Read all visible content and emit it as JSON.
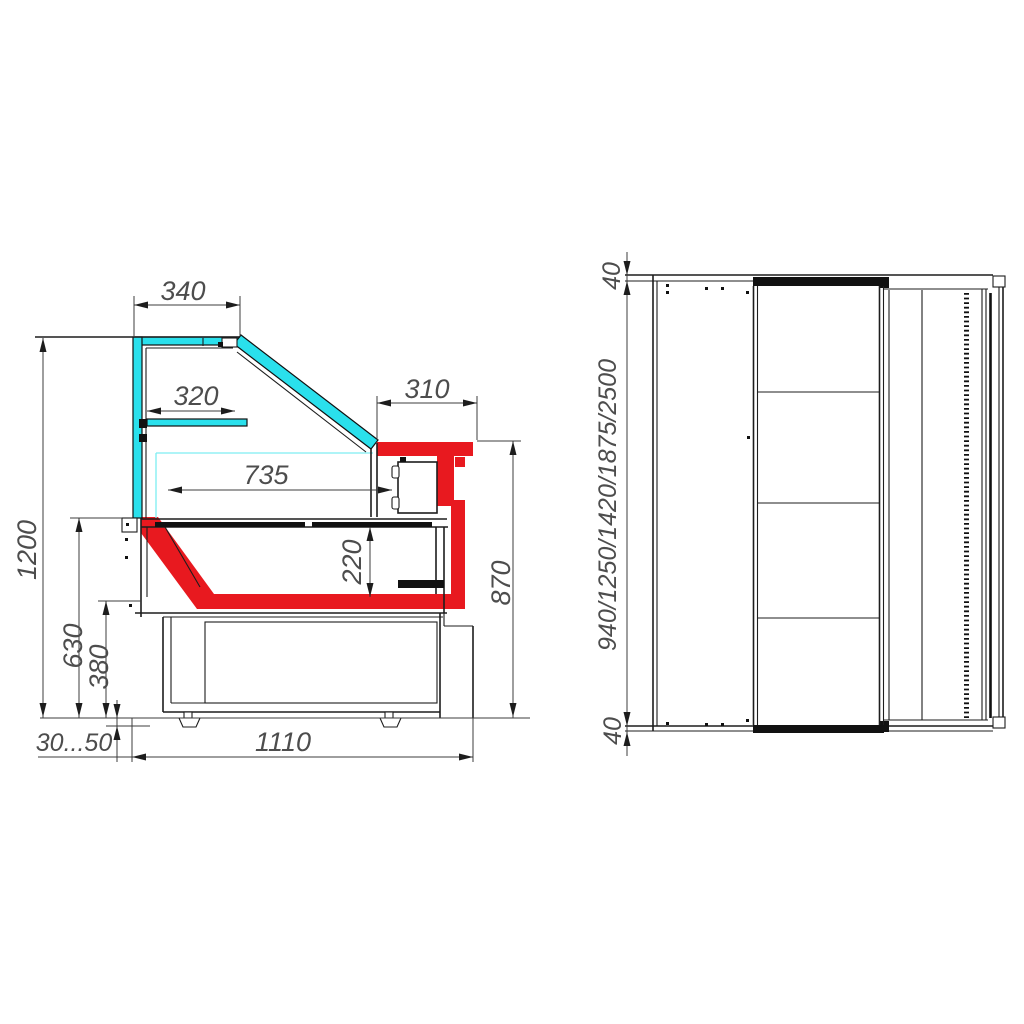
{
  "drawing": {
    "background": "#ffffff",
    "colors": {
      "highlight_red": "#e8191f",
      "glass_cyan": "#2ae0ec",
      "line": "#1d1d1d",
      "dim_text": "#4d4d4d"
    },
    "side_view": {
      "dims": {
        "canopy_width": "340",
        "shelf_width": "320",
        "worktop_width": "310",
        "display_depth": "735",
        "overall_height": "1200",
        "glass_base_height": "630",
        "deck_lower_height": "380",
        "well_depth": "220",
        "worktop_height": "870",
        "feet_adjust": "30...50",
        "base_depth": "1110"
      }
    },
    "top_view": {
      "dims": {
        "end_panel_top": "40",
        "length_options": "940/1250/1420/1875/2500",
        "end_panel_bottom": "40"
      }
    }
  }
}
